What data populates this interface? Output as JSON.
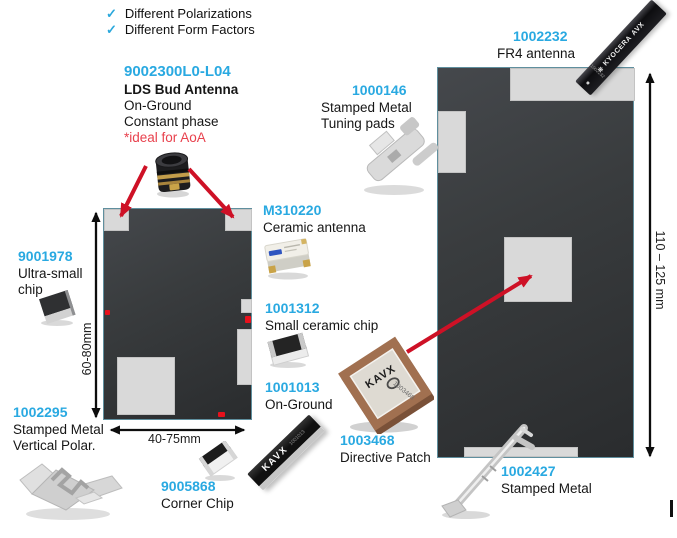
{
  "checklist": {
    "check_glyph": "✓",
    "items": [
      {
        "label": "Different Polarizations"
      },
      {
        "label": "Different Form Factors"
      }
    ]
  },
  "products": {
    "lds_bud": {
      "part": "9002300L0-L04",
      "name": "LDS Bud Antenna",
      "line1": "On-Ground",
      "line2": "Constant phase",
      "note": "*ideal for AoA"
    },
    "ultra_small_chip": {
      "part": "9001978",
      "line1": "Ultra-small",
      "line2": "chip"
    },
    "stamped_vertical": {
      "part": "1002295",
      "line1": "Stamped Metal",
      "line2": "Vertical Polar."
    },
    "corner_chip": {
      "part": "9005868",
      "line1": "Corner Chip"
    },
    "ceramic_antenna": {
      "part": "M310220",
      "line1": "Ceramic antenna"
    },
    "small_ceramic_chip": {
      "part": "1001312",
      "line1": "Small ceramic chip"
    },
    "on_ground_stick": {
      "part": "1001013",
      "line1": "On-Ground"
    },
    "directive_patch": {
      "part": "1003468",
      "line1": "Directive Patch"
    },
    "tuning_pads": {
      "part": "1000146",
      "line1": "Stamped Metal",
      "line2": "Tuning pads"
    },
    "fr4_antenna": {
      "part": "1002232",
      "line1": "FR4 antenna"
    },
    "stamped_metal": {
      "part": "1002427",
      "line1": "Stamped Metal"
    }
  },
  "markings": {
    "fr4_logo_glyph": "❋",
    "fr4_brand_1": "KYOCERA",
    "fr4_brand_2": "AVX",
    "fr4_part": "1002232",
    "kavx_stick_brand": "KAVX",
    "kavx_stick_part": "1001013",
    "patch_brand": "KAVX",
    "patch_part": "1003468"
  },
  "dimensions": {
    "left_board_height": "60-80mm",
    "left_board_width": "40-75mm",
    "right_board_height": "110 – 125 mm"
  },
  "colors": {
    "accent_cyan": "#29A9E1",
    "note_red": "#E8414D",
    "arrow_red": "#CE1126",
    "board_fill": "#37393B",
    "pad_gray": "#D9D9D9"
  }
}
